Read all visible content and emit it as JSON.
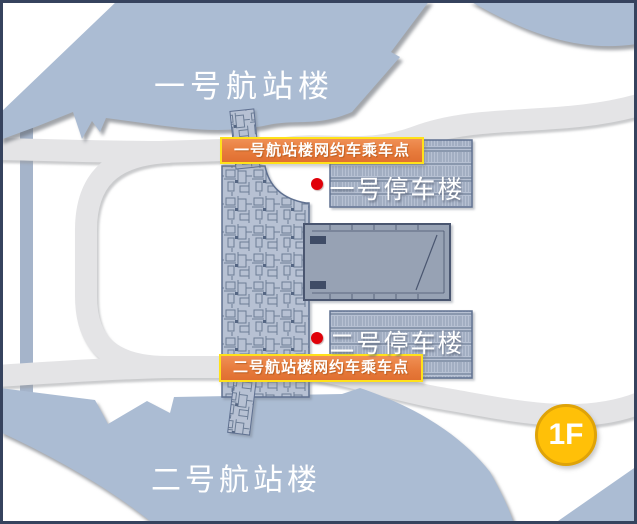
{
  "map": {
    "terminal1": {
      "title": "一号航站楼"
    },
    "terminal2": {
      "title": "二号航站楼"
    },
    "parking1": {
      "title": "一号停车楼"
    },
    "parking2": {
      "title": "二号停车楼"
    },
    "pickup_points": [
      {
        "label": "一号航站楼网约车乘车点"
      },
      {
        "label": "二号航站楼网约车乘车点"
      }
    ],
    "floor_badge": "1F",
    "colors": {
      "accent_orange": "#e77b3c",
      "label_border_yellow": "#ffe11a",
      "badge_gold": "#ffc008",
      "marker_red": "#e00009",
      "shape_blue": "#abbcd3",
      "road_gray": "#e4e4e6",
      "frame_navy": "#36435e"
    }
  }
}
